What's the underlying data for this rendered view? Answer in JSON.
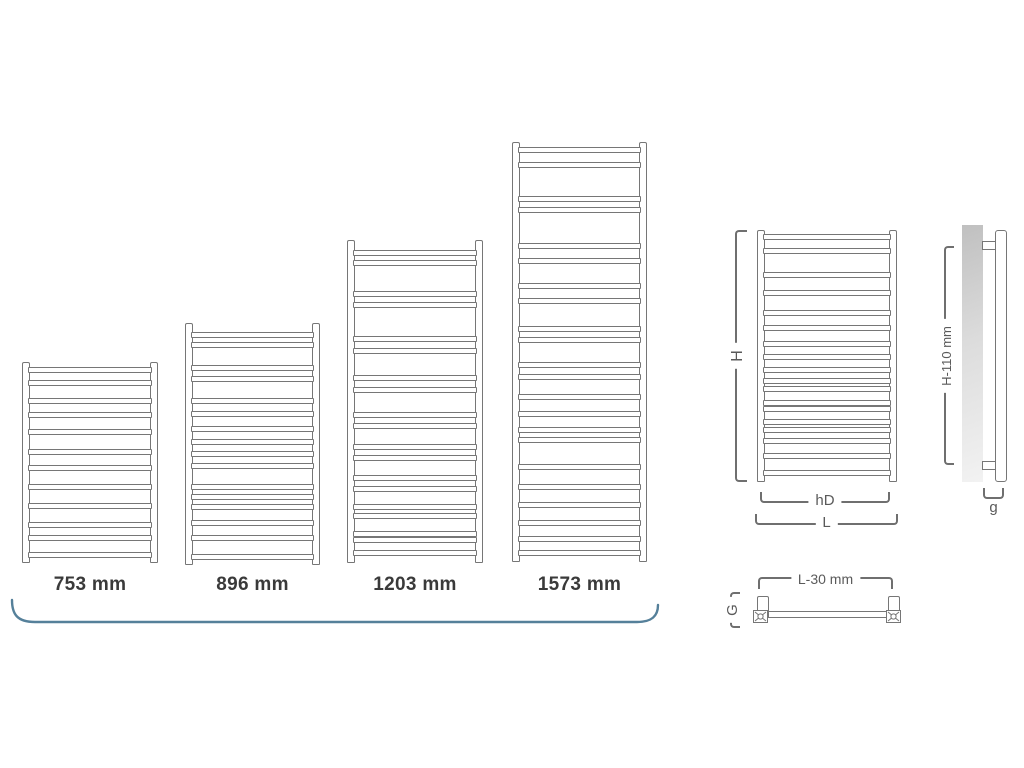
{
  "canvas": {
    "width": 1024,
    "height": 768,
    "background": "#ffffff"
  },
  "colors": {
    "outline": "#767676",
    "dimension_line": "#6f6f6f",
    "dimension_text": "#5a5a5a",
    "size_label_text": "#3a3a3a",
    "underline_curve": "#55809a"
  },
  "size_variants": {
    "heights_mm": [
      753,
      896,
      1203,
      1573
    ],
    "label_top": 574,
    "items": [
      {
        "height_label": "753 mm",
        "x": 22,
        "top": 362,
        "width": 136,
        "height": 201,
        "rungs": [
          0.015,
          0.085,
          0.178,
          0.249,
          0.338,
          0.447,
          0.527,
          0.627,
          0.726,
          0.826,
          0.896,
          0.985
        ]
      },
      {
        "height_label": "896 mm",
        "x": 185,
        "top": 323,
        "width": 135,
        "height": 242,
        "rungs": [
          0.029,
          0.074,
          0.174,
          0.219,
          0.314,
          0.372,
          0.434,
          0.492,
          0.545,
          0.595,
          0.686,
          0.727,
          0.773,
          0.839,
          0.905,
          0.988
        ]
      },
      {
        "height_label": "1203 mm",
        "x": 347,
        "top": 240,
        "width": 136,
        "height": 323,
        "rungs": [
          0.025,
          0.056,
          0.155,
          0.192,
          0.3,
          0.34,
          0.424,
          0.464,
          0.542,
          0.579,
          0.645,
          0.681,
          0.743,
          0.78,
          0.836,
          0.867,
          0.923,
          0.944,
          0.985
        ]
      },
      {
        "height_label": "1573 mm",
        "x": 512,
        "top": 142,
        "width": 135,
        "height": 420,
        "rungs": [
          0.007,
          0.043,
          0.126,
          0.154,
          0.241,
          0.277,
          0.34,
          0.376,
          0.443,
          0.471,
          0.531,
          0.562,
          0.61,
          0.65,
          0.69,
          0.714,
          0.78,
          0.829,
          0.872,
          0.916,
          0.955,
          0.991
        ]
      }
    ]
  },
  "front_view": {
    "x": 757,
    "top": 230,
    "width": 140,
    "height": 252,
    "rungs": [
      0.007,
      0.066,
      0.165,
      0.238,
      0.324,
      0.384,
      0.45,
      0.503,
      0.556,
      0.602,
      0.635,
      0.694,
      0.721,
      0.774,
      0.807,
      0.853,
      0.913,
      0.985
    ]
  },
  "dimensions": {
    "height": "H",
    "inner_width": "hD",
    "overall_width": "L",
    "side_height": "H-110 mm",
    "side_depth": "g",
    "top_width": "L-30 mm",
    "top_depth": "G"
  }
}
